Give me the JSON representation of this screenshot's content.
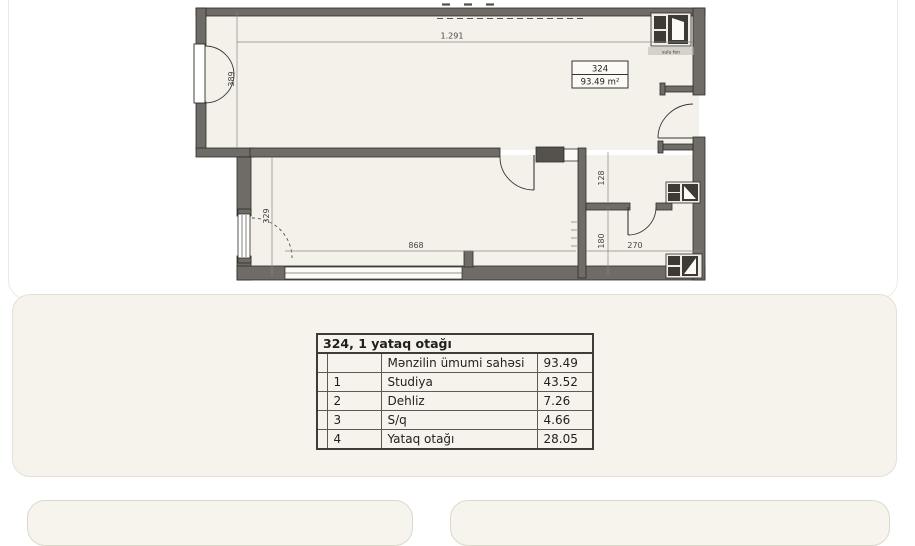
{
  "plan": {
    "unit": {
      "number": "324",
      "area": "93.49 m²"
    },
    "dims": {
      "width_top": "1.291",
      "entry": "389",
      "bedroom_h": "329",
      "bedroom_w": "868",
      "hall": "128",
      "bath_h": "180",
      "bath_w": "270"
    },
    "shaft": "sulu fen"
  },
  "table": {
    "title": "324, 1 yataq otağı",
    "rows": [
      {
        "num": "",
        "name": "Mənzilin ümumi sahəsi",
        "value": "93.49"
      },
      {
        "num": "1",
        "name": "Studiya",
        "value": "43.52"
      },
      {
        "num": "2",
        "name": "Dehliz",
        "value": "7.26"
      },
      {
        "num": "3",
        "name": "S/q",
        "value": "4.66"
      },
      {
        "num": "4",
        "name": "Yataq otağı",
        "value": "28.05"
      }
    ]
  }
}
